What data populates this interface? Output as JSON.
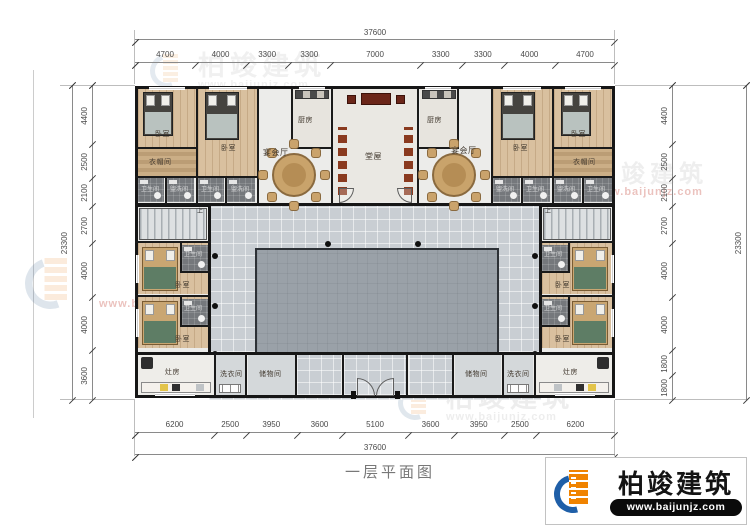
{
  "title": "一层平面图",
  "brand": {
    "name": "柏竣建筑",
    "url": "www.baijunjz.com"
  },
  "dimensions": {
    "top": {
      "total": "37600",
      "segments": [
        "4700",
        "4000",
        "3300",
        "3300",
        "7000",
        "3300",
        "3300",
        "4000",
        "4700"
      ]
    },
    "bottom": {
      "total": "37600",
      "segments": [
        "6200",
        "2500",
        "3950",
        "3600",
        "5100",
        "3600",
        "3950",
        "2500",
        "6200"
      ]
    },
    "left": {
      "total": "23300",
      "segments": [
        "4400",
        "2500",
        "2100",
        "2700",
        "4000",
        "4000",
        "3600"
      ]
    },
    "right": {
      "total": "23300",
      "segments": [
        "4400",
        "2500",
        "2100",
        "2700",
        "4000",
        "4000",
        "1800",
        "1800"
      ]
    }
  },
  "rooms": {
    "bedroom": "卧室",
    "banquet_hall": "宴会厅",
    "main_hall": "堂屋",
    "kitchen": "厨房",
    "cloakroom": "衣帽间",
    "bathroom": "卫生间",
    "washroom": "盥洗间",
    "stove_room": "灶房",
    "laundry": "洗衣间",
    "storage": "储物间"
  },
  "stairs_up_label": "上",
  "colors": {
    "wall": "#1a1a1a",
    "corridor": "#c9ced3",
    "courtyard": "#9aa1a8",
    "wood_floor": "#d9c09f",
    "brand_orange": "#f08300",
    "brand_blue": "#1f5fa8",
    "url_bar": "#0b0b0b",
    "watermark_red": "#c0392b"
  }
}
